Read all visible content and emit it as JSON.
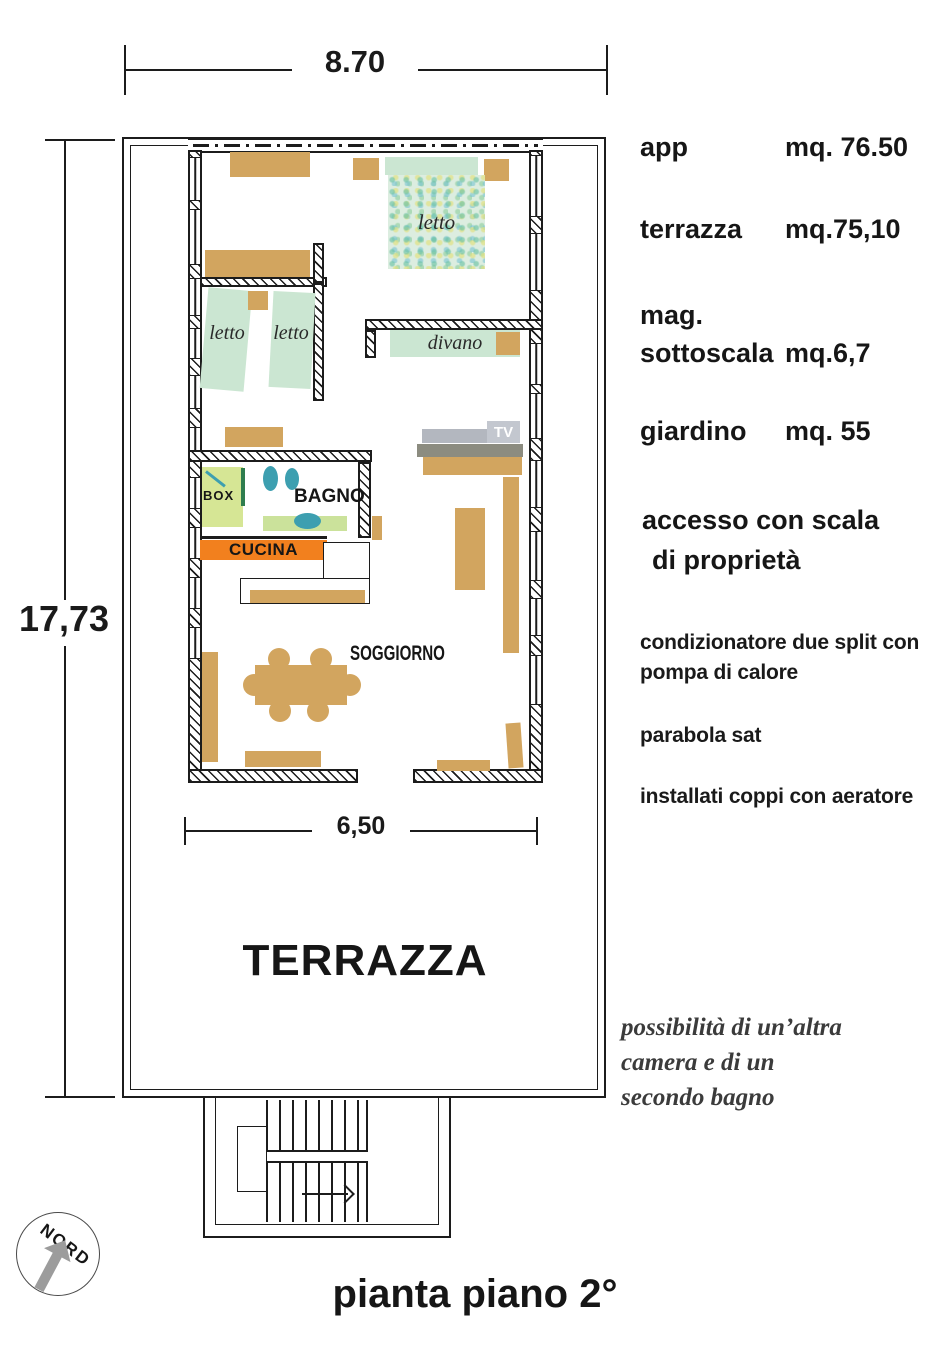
{
  "title": "pianta piano 2°",
  "dimensions": {
    "width_top": "8.70",
    "height_left": "17,73",
    "width_inner": "6,50"
  },
  "compass": {
    "north_label": "NORD"
  },
  "rooms": {
    "bedroom_main": "letto",
    "bedroom_twin_a": "letto",
    "bedroom_twin_b": "letto",
    "sofa": "divano",
    "tv": "TV",
    "shower_box": "BOX",
    "bathroom": "BAGNO",
    "kitchen": "CUCINA",
    "living_room": "SOGGIORNO",
    "terrace": "TERRAZZA"
  },
  "measurements": [
    {
      "label": "app",
      "value": "mq. 76.50"
    },
    {
      "label": "terrazza",
      "value": "mq.75,10"
    },
    {
      "label": "mag.",
      "value": ""
    },
    {
      "label": "sottoscala",
      "value": "mq.6,7"
    },
    {
      "label": "giardino",
      "value": "mq. 55"
    }
  ],
  "notes": {
    "access_line1": "accesso con scala",
    "access_line2": "di proprietà",
    "aircon_line1": "condizionatore due split con",
    "aircon_line2": "pompa di calore",
    "satellite": "parabola sat",
    "roof": "installati coppi con aeratore"
  },
  "remark": {
    "line1": "possibilità di un’altra",
    "line2": "camera e di un",
    "line3": "secondo bagno"
  },
  "colors": {
    "line": "#1c1c1c",
    "furniture_tan": "#d2a55f",
    "fabric_green": "#cbe6d2",
    "fixture_teal": "#3d9fb0",
    "shower_floor": "#d6e695",
    "shower_door_green": "#2f7d4e",
    "mat_green": "#cbe29b",
    "kitchen_orange": "#f2801e",
    "tv_gray": "#b3b7bf",
    "tv_light_gray": "#c3c7cf",
    "tv_dark_gray": "#8c8c80",
    "compass_arrow_gray": "#9c9c9c"
  }
}
